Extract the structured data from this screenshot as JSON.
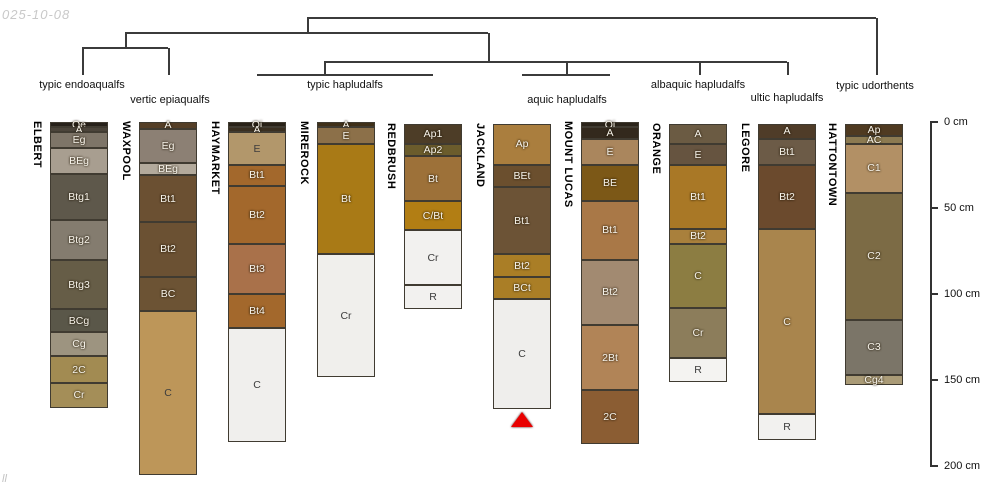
{
  "meta": {
    "date_stamp": "025-10-08",
    "footer_mark": "ll",
    "background": "#ffffff",
    "marker_color": "#e90000"
  },
  "layout": {
    "axis_x": 930,
    "axis_top_px": 122,
    "px_per_cm": 1.72,
    "col_width": 58,
    "tick_len": 8,
    "line_weight": 1.5
  },
  "chart_data": {
    "type": "soil-profile-columns-with-dendrogram",
    "title": "",
    "depth_axis": {
      "unit": "cm",
      "range": [
        0,
        200
      ],
      "ticks": [
        {
          "cm": 0,
          "label": "0 cm"
        },
        {
          "cm": 50,
          "label": "50 cm"
        },
        {
          "cm": 100,
          "label": "100 cm"
        },
        {
          "cm": 150,
          "label": "150 cm"
        },
        {
          "cm": 200,
          "label": "200 cm"
        }
      ]
    },
    "dendrogram": {
      "segments": [
        [
          307,
          18,
          876,
          18
        ],
        [
          307,
          18,
          307,
          33
        ],
        [
          876,
          18,
          876,
          75
        ],
        [
          125,
          33,
          488,
          33
        ],
        [
          125,
          33,
          125,
          48
        ],
        [
          488,
          33,
          488,
          62
        ],
        [
          82,
          48,
          168,
          48
        ],
        [
          82,
          48,
          82,
          75
        ],
        [
          168,
          48,
          168,
          75
        ],
        [
          324,
          62,
          787,
          62
        ],
        [
          324,
          62,
          324,
          75
        ],
        [
          257,
          75,
          433,
          75
        ],
        [
          566,
          62,
          566,
          75
        ],
        [
          522,
          75,
          610,
          75
        ],
        [
          699,
          62,
          699,
          75
        ],
        [
          787,
          62,
          787,
          75
        ]
      ],
      "group_labels": [
        {
          "text": "typic endoaqualfs",
          "x": 82,
          "y": 85
        },
        {
          "text": "vertic epiaqualfs",
          "x": 170,
          "y": 100
        },
        {
          "text": "typic hapludalfs",
          "x": 345,
          "y": 85
        },
        {
          "text": "aquic hapludalfs",
          "x": 567,
          "y": 100
        },
        {
          "text": "albaquic hapludalfs",
          "x": 698,
          "y": 85
        },
        {
          "text": "ultic hapludalfs",
          "x": 787,
          "y": 98
        },
        {
          "text": "typic udorthents",
          "x": 875,
          "y": 86
        }
      ]
    },
    "profiles": [
      {
        "name": "ELBERT",
        "x": 50,
        "group": "typic endoaqualfs",
        "horizons": [
          {
            "label": "Oe",
            "top": 0,
            "bottom": 3,
            "color": "#27211a",
            "tc": "w"
          },
          {
            "label": "A",
            "top": 3,
            "bottom": 6,
            "color": "#4b443a",
            "tc": "w"
          },
          {
            "label": "Eg",
            "top": 6,
            "bottom": 15,
            "color": "#7e7568",
            "tc": "w"
          },
          {
            "label": "BEg",
            "top": 15,
            "bottom": 30,
            "color": "#a89e90",
            "tc": "w"
          },
          {
            "label": "Btg1",
            "top": 30,
            "bottom": 57,
            "color": "#5e584b",
            "tc": "w"
          },
          {
            "label": "Btg2",
            "top": 57,
            "bottom": 80,
            "color": "#847c6f",
            "tc": "w"
          },
          {
            "label": "Btg3",
            "top": 80,
            "bottom": 109,
            "color": "#665d47",
            "tc": "w"
          },
          {
            "label": "BCg",
            "top": 109,
            "bottom": 122,
            "color": "#5a5749",
            "tc": "w"
          },
          {
            "label": "Cg",
            "top": 122,
            "bottom": 136,
            "color": "#9d9480",
            "tc": "w"
          },
          {
            "label": "2C",
            "top": 136,
            "bottom": 152,
            "color": "#a28b52",
            "tc": "w"
          },
          {
            "label": "Cr",
            "top": 152,
            "bottom": 166,
            "color": "#a48e58",
            "tc": "w"
          }
        ]
      },
      {
        "name": "WAXPOOL",
        "x": 139,
        "group": "vertic epiaqualfs",
        "horizons": [
          {
            "label": "A",
            "top": 0,
            "bottom": 4,
            "color": "#553f27",
            "tc": "w"
          },
          {
            "label": "Eg",
            "top": 4,
            "bottom": 24,
            "color": "#8c8074",
            "tc": "w"
          },
          {
            "label": "BEg",
            "top": 24,
            "bottom": 31,
            "color": "#b3aa9c",
            "tc": "w"
          },
          {
            "label": "Bt1",
            "top": 31,
            "bottom": 58,
            "color": "#6b5032",
            "tc": "w"
          },
          {
            "label": "Bt2",
            "top": 58,
            "bottom": 90,
            "color": "#6b5133",
            "tc": "w"
          },
          {
            "label": "BC",
            "top": 90,
            "bottom": 110,
            "color": "#6c5334",
            "tc": "w"
          },
          {
            "label": "C",
            "top": 110,
            "bottom": 205,
            "color": "#bd9659",
            "tc": "d"
          }
        ]
      },
      {
        "name": "HAYMARKET",
        "x": 228,
        "group": "typic hapludalfs",
        "horizons": [
          {
            "label": "Oi",
            "top": 0,
            "bottom": 3,
            "color": "#292218",
            "tc": "w"
          },
          {
            "label": "A",
            "top": 3,
            "bottom": 6,
            "color": "#3a2f20",
            "tc": "w"
          },
          {
            "label": "E",
            "top": 6,
            "bottom": 25,
            "color": "#b2976b",
            "tc": "d"
          },
          {
            "label": "Bt1",
            "top": 25,
            "bottom": 37,
            "color": "#a3682c",
            "tc": "w"
          },
          {
            "label": "Bt2",
            "top": 37,
            "bottom": 71,
            "color": "#a3682c",
            "tc": "w"
          },
          {
            "label": "Bt3",
            "top": 71,
            "bottom": 100,
            "color": "#a9714a",
            "tc": "w"
          },
          {
            "label": "Bt4",
            "top": 100,
            "bottom": 120,
            "color": "#a3682c",
            "tc": "w"
          },
          {
            "label": "C",
            "top": 120,
            "bottom": 186,
            "color": "#f0efed",
            "tc": "d"
          }
        ]
      },
      {
        "name": "MIREROCK",
        "x": 317,
        "group": "typic hapludalfs",
        "horizons": [
          {
            "label": "A",
            "top": 0,
            "bottom": 3,
            "color": "#3f3019",
            "tc": "w"
          },
          {
            "label": "E",
            "top": 3,
            "bottom": 13,
            "color": "#8c7049",
            "tc": "w"
          },
          {
            "label": "Bt",
            "top": 13,
            "bottom": 77,
            "color": "#a97a16",
            "tc": "w"
          },
          {
            "label": "Cr",
            "top": 77,
            "bottom": 148,
            "color": "#f0efec",
            "tc": "d"
          }
        ]
      },
      {
        "name": "REDBRUSH",
        "x": 404,
        "group": "typic hapludalfs",
        "horizons": [
          {
            "label": "Ap1",
            "top": 1,
            "bottom": 13,
            "color": "#4d3d27",
            "tc": "w"
          },
          {
            "label": "Ap2",
            "top": 13,
            "bottom": 20,
            "color": "#6b5c2c",
            "tc": "w"
          },
          {
            "label": "Bt",
            "top": 20,
            "bottom": 46,
            "color": "#9d7139",
            "tc": "w"
          },
          {
            "label": "C/Bt",
            "top": 46,
            "bottom": 63,
            "color": "#b27e14",
            "tc": "w"
          },
          {
            "label": "Cr",
            "top": 63,
            "bottom": 95,
            "color": "#f2f1ef",
            "tc": "d"
          },
          {
            "label": "R",
            "top": 95,
            "bottom": 109,
            "color": "#f2f1ef",
            "tc": "d"
          }
        ]
      },
      {
        "name": "JACKLAND",
        "x": 493,
        "group": "aquic hapludalfs",
        "marker": true,
        "horizons": [
          {
            "label": "Ap",
            "top": 1,
            "bottom": 25,
            "color": "#aa7e3e",
            "tc": "w"
          },
          {
            "label": "BEt",
            "top": 25,
            "bottom": 38,
            "color": "#6b4f2e",
            "tc": "w"
          },
          {
            "label": "Bt1",
            "top": 38,
            "bottom": 77,
            "color": "#6c5336",
            "tc": "w"
          },
          {
            "label": "Bt2",
            "top": 77,
            "bottom": 90,
            "color": "#aa7e26",
            "tc": "w"
          },
          {
            "label": "BCt",
            "top": 90,
            "bottom": 103,
            "color": "#aa7e26",
            "tc": "w"
          },
          {
            "label": "C",
            "top": 103,
            "bottom": 167,
            "color": "#efeeec",
            "tc": "d"
          }
        ]
      },
      {
        "name": "MOUNT LUCAS",
        "x": 581,
        "group": "aquic hapludalfs",
        "horizons": [
          {
            "label": "Oi",
            "top": 0,
            "bottom": 3,
            "color": "#2b241a",
            "tc": "w"
          },
          {
            "label": "A",
            "top": 3,
            "bottom": 10,
            "color": "#33291d",
            "tc": "w"
          },
          {
            "label": "E",
            "top": 10,
            "bottom": 25,
            "color": "#aa865d",
            "tc": "w"
          },
          {
            "label": "BE",
            "top": 25,
            "bottom": 46,
            "color": "#7c5817",
            "tc": "w"
          },
          {
            "label": "Bt1",
            "top": 46,
            "bottom": 80,
            "color": "#a97847",
            "tc": "w"
          },
          {
            "label": "Bt2",
            "top": 80,
            "bottom": 118,
            "color": "#a28a71",
            "tc": "w"
          },
          {
            "label": "2Bt",
            "top": 118,
            "bottom": 156,
            "color": "#b18457",
            "tc": "w"
          },
          {
            "label": "2C",
            "top": 156,
            "bottom": 187,
            "color": "#8b5d33",
            "tc": "w"
          }
        ]
      },
      {
        "name": "ORANGE",
        "x": 669,
        "group": "albaquic hapludalfs",
        "horizons": [
          {
            "label": "A",
            "top": 1,
            "bottom": 13,
            "color": "#6b5b43",
            "tc": "w"
          },
          {
            "label": "E",
            "top": 13,
            "bottom": 25,
            "color": "#665440",
            "tc": "w"
          },
          {
            "label": "Bt1",
            "top": 25,
            "bottom": 62,
            "color": "#a97826",
            "tc": "w"
          },
          {
            "label": "Bt2",
            "top": 62,
            "bottom": 71,
            "color": "#a9803c",
            "tc": "w"
          },
          {
            "label": "C",
            "top": 71,
            "bottom": 108,
            "color": "#8c7d42",
            "tc": "w"
          },
          {
            "label": "Cr",
            "top": 108,
            "bottom": 137,
            "color": "#8c7d5b",
            "tc": "w"
          },
          {
            "label": "R",
            "top": 137,
            "bottom": 151,
            "color": "#f4f3f1",
            "tc": "d"
          }
        ]
      },
      {
        "name": "LEGORE",
        "x": 758,
        "group": "ultic hapludalfs",
        "horizons": [
          {
            "label": "A",
            "top": 1,
            "bottom": 10,
            "color": "#4f3c28",
            "tc": "w"
          },
          {
            "label": "Bt1",
            "top": 10,
            "bottom": 25,
            "color": "#6c5b47",
            "tc": "w"
          },
          {
            "label": "Bt2",
            "top": 25,
            "bottom": 62,
            "color": "#6b4a2d",
            "tc": "w"
          },
          {
            "label": "C",
            "top": 62,
            "bottom": 170,
            "color": "#a9854d",
            "tc": "w"
          },
          {
            "label": "R",
            "top": 170,
            "bottom": 185,
            "color": "#f2f1ef",
            "tc": "d"
          }
        ]
      },
      {
        "name": "HATTONTOWN",
        "x": 845,
        "group": "typic udorthents",
        "horizons": [
          {
            "label": "Ap",
            "top": 1,
            "bottom": 8,
            "color": "#4f3a21",
            "tc": "w"
          },
          {
            "label": "AC",
            "top": 8,
            "bottom": 13,
            "color": "#8c7a51",
            "tc": "w"
          },
          {
            "label": "C1",
            "top": 13,
            "bottom": 41,
            "color": "#b29065",
            "tc": "w"
          },
          {
            "label": "C2",
            "top": 41,
            "bottom": 115,
            "color": "#7c6b45",
            "tc": "w"
          },
          {
            "label": "C3",
            "top": 115,
            "bottom": 147,
            "color": "#7b7568",
            "tc": "w"
          },
          {
            "label": "Cg4",
            "top": 147,
            "bottom": 153,
            "color": "#aa9b77",
            "tc": "w"
          }
        ]
      }
    ]
  }
}
